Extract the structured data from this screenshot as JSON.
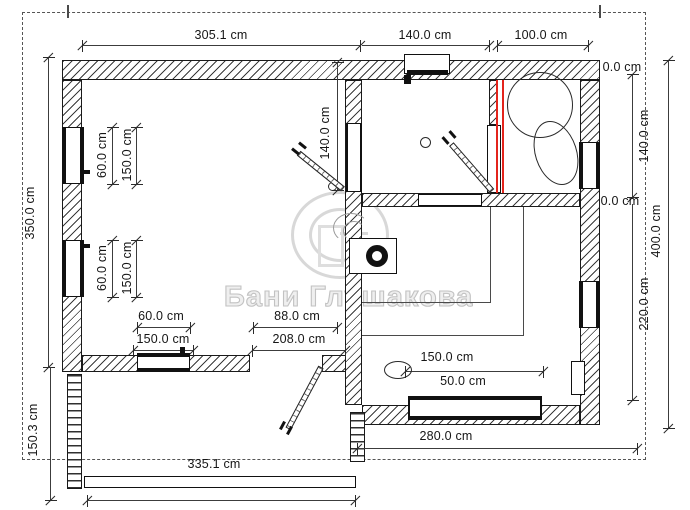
{
  "watermark": {
    "text": "Бани Глушакова",
    "logo": "GL-monogram"
  },
  "colors": {
    "line": "#1a1a1a",
    "red_partition": "#e3241c",
    "watermark_gray": "#c2c2c2"
  },
  "units": "cm",
  "dims": {
    "top_width_main": "305.1 cm",
    "top_width_wash": "140.0 cm",
    "top_width_steam": "100.0 cm",
    "left_height_main": "350.0 cm",
    "left_height_porch": "150.3 cm",
    "mid_door_height": "140.0 cm",
    "right_zero_top": "0.0 cm",
    "right_steam_height": "140.0 cm",
    "right_zero_bottom": "0.0 cm",
    "right_total_height": "400.0 cm",
    "right_rest_height": "220.0 cm",
    "bottom_rest_width": "280.0 cm",
    "bottom_porch_width": "335.1 cm",
    "win_left1_width": "60.0 cm",
    "win_left1_sill": "150.0 cm",
    "win_left2_width": "60.0 cm",
    "win_left2_sill": "150.0 cm",
    "win_bottom_width": "60.0 cm",
    "win_bottom_sill": "150.0 cm",
    "door_porch_width": "88.0 cm",
    "door_porch_offset": "208.0 cm",
    "win_rest_width": "150.0 cm",
    "win_rest_sill": "50.0 cm"
  }
}
